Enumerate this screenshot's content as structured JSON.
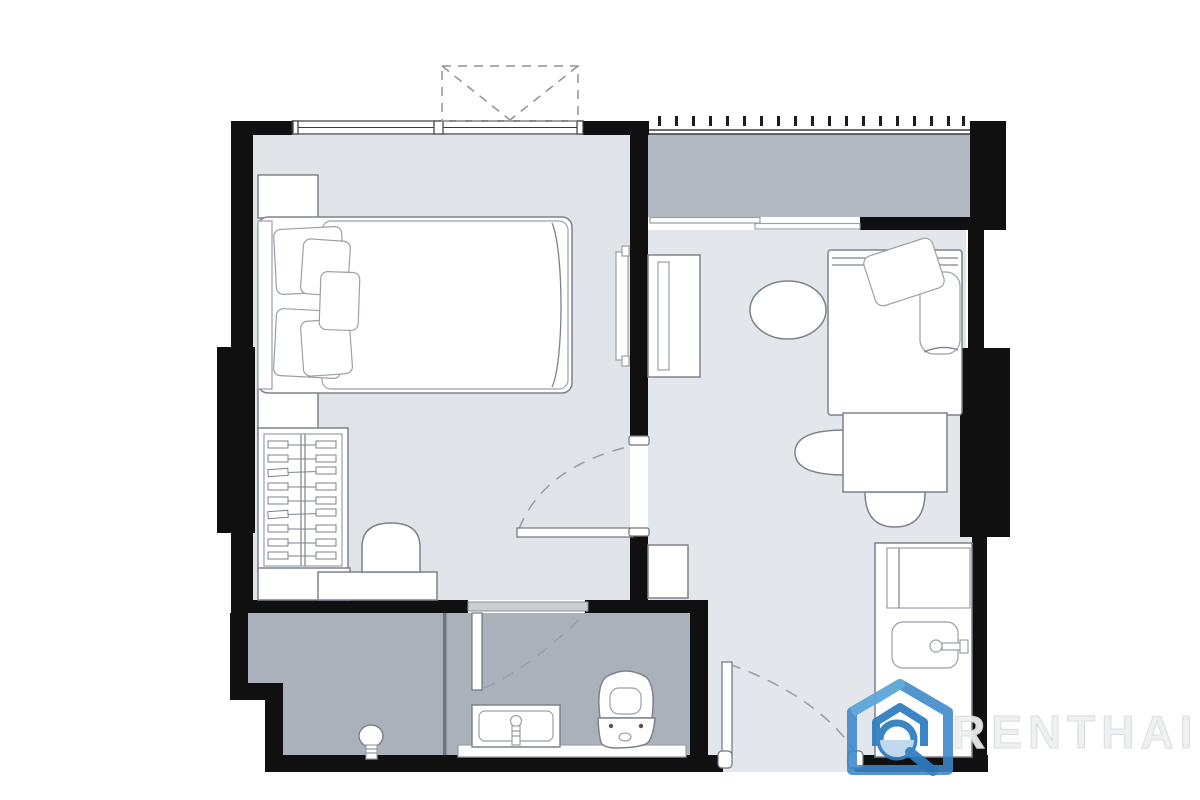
{
  "page": {
    "background": "#ffffff",
    "content": "apartment floor plan drawing, no room labels"
  },
  "watermark": {
    "brand_text": "RENTHAI",
    "logo_icon": "house-search-icon",
    "logo_color_primary": "#2e7cc0",
    "logo_color_secondary": "#5aa5d8",
    "text_color": "#edeff1"
  },
  "palette": {
    "wall": "#101010",
    "bedroom_floor": "#e0e4e9",
    "living_floor": "#e3e6eb",
    "balcony_floor": "#b3b9c3",
    "bathroom_floor": "#aab1bb",
    "furniture_fill": "#ffffff",
    "furniture_stroke": "#7d828b",
    "door_arc": "#9aa0a8"
  },
  "floor_plan": {
    "rooms": [
      {
        "id": "bedroom",
        "features": [
          "double-bed",
          "five-pillows",
          "nightstand-top",
          "nightstand-bottom",
          "wardrobe-with-hangers",
          "vanity-desk",
          "stool",
          "wall-tv",
          "top-window",
          "ac-ledge"
        ]
      },
      {
        "id": "living-area",
        "features": [
          "tv-console",
          "oval-pouf",
          "daybed-sofa",
          "dining-table",
          "dining-chair-left",
          "dining-chair-bottom"
        ]
      },
      {
        "id": "balcony",
        "features": [
          "railing-with-ticks",
          "sliding-glass-door"
        ]
      },
      {
        "id": "bathroom",
        "features": [
          "shower-area",
          "floor-drain",
          "glass-partition",
          "washbasin-vanity",
          "toilet",
          "swing-door"
        ]
      },
      {
        "id": "entrance-hall",
        "features": [
          "entrance-door",
          "shoe-cabinet"
        ]
      },
      {
        "id": "kitchenette",
        "features": [
          "counter-with-sink",
          "refrigerator"
        ]
      }
    ],
    "doors": [
      "entrance-door",
      "bedroom-door",
      "bathroom-door",
      "balcony-sliding-door"
    ],
    "windows": [
      "bedroom-window"
    ]
  }
}
